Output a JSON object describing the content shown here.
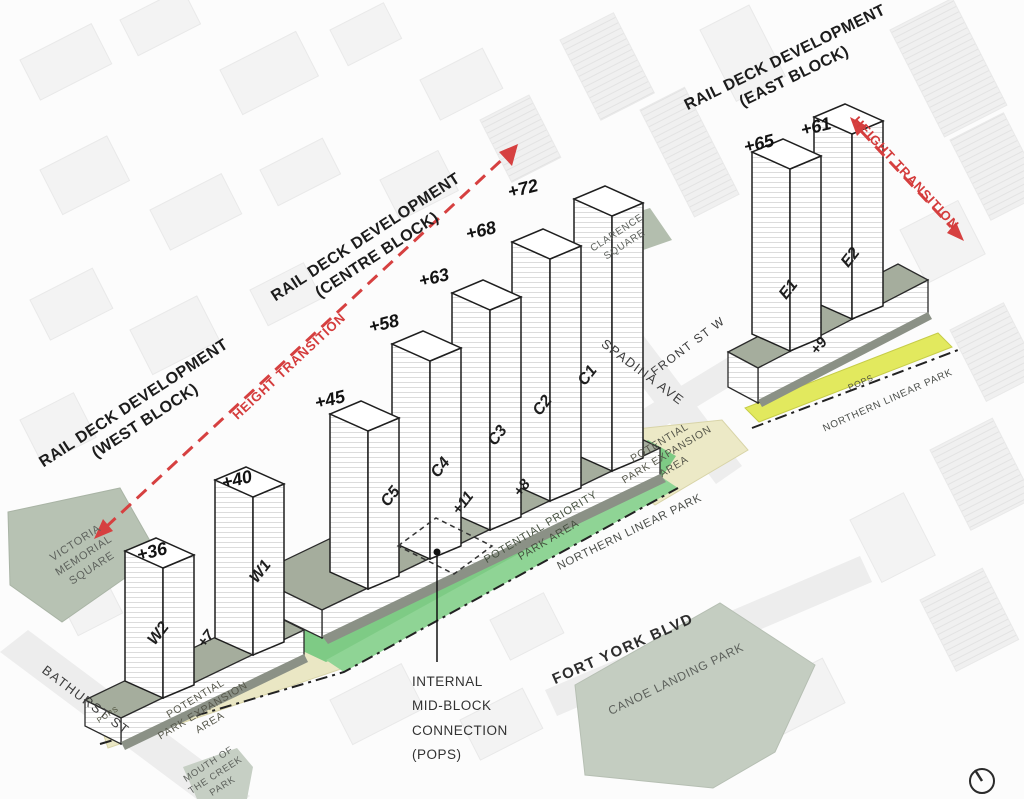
{
  "title_blocks": {
    "west": {
      "line1": "RAIL DECK DEVELOPMENT",
      "line2": "(WEST BLOCK)"
    },
    "centre": {
      "line1": "RAIL DECK DEVELOPMENT",
      "line2": "(CENTRE BLOCK)"
    },
    "east": {
      "line1": "RAIL DECK DEVELOPMENT",
      "line2": "(EAST BLOCK)"
    }
  },
  "towers": [
    {
      "id": "W2",
      "height": "+36"
    },
    {
      "id": "W1",
      "height": "+40"
    },
    {
      "id": "C5",
      "height": "+45"
    },
    {
      "id": "C4",
      "height": "+58"
    },
    {
      "id": "C3",
      "height": "+63"
    },
    {
      "id": "C2",
      "height": "+68"
    },
    {
      "id": "C1",
      "height": "+72"
    },
    {
      "id": "E1",
      "height": "+65"
    },
    {
      "id": "E2",
      "height": "+61"
    }
  ],
  "podium_labels": [
    {
      "label": "+7"
    },
    {
      "label": "+11"
    },
    {
      "label": "+8"
    },
    {
      "label": "+9"
    }
  ],
  "height_transition": {
    "west": "HEIGHT TRANSITION",
    "east": "HEIGHT TRANSITION"
  },
  "internal_connection": {
    "line1": "INTERNAL",
    "line2": "MID-BLOCK",
    "line3": "CONNECTION",
    "line4": "(POPS)"
  },
  "streets": {
    "bathurst": "BATHURST ST",
    "spadina": "SPADINA AVE",
    "front": "FRONT ST W",
    "fort_york": "FORT YORK BLVD"
  },
  "parks": {
    "victoria": {
      "line1": "VICTORIA",
      "line2": "MEMORIAL",
      "line3": "SQUARE"
    },
    "clarence": {
      "line1": "CLARENCE",
      "line2": "SQUARE"
    },
    "canoe": "CANOE LANDING PARK",
    "mouth": {
      "line1": "MOUTH OF",
      "line2": "THE CREEK",
      "line3": "PARK"
    },
    "priority": {
      "line1": "POTENTIAL PRIORITY",
      "line2": "PARK AREA"
    },
    "expansion_west": {
      "line1": "POTENTIAL",
      "line2": "PARK EXPANSION",
      "line3": "AREA"
    },
    "expansion_east": {
      "line1": "POTENTIAL",
      "line2": "PARK EXPANSION",
      "line3": "AREA"
    },
    "northern_linear_centre": "NORTHERN LINEAR PARK",
    "northern_linear_east": "NORTHERN LINEAR PARK",
    "pops_west": "POPS",
    "pops_east": "POPS"
  },
  "colors": {
    "accent_red": "#d43c3c",
    "priority_green": "#7ecb85",
    "expansion_beige": "#eae7c4",
    "pops_yellow": "#e2e95e",
    "square_green": "#b7c2b3",
    "deck_grey": "#a5ad9d"
  }
}
